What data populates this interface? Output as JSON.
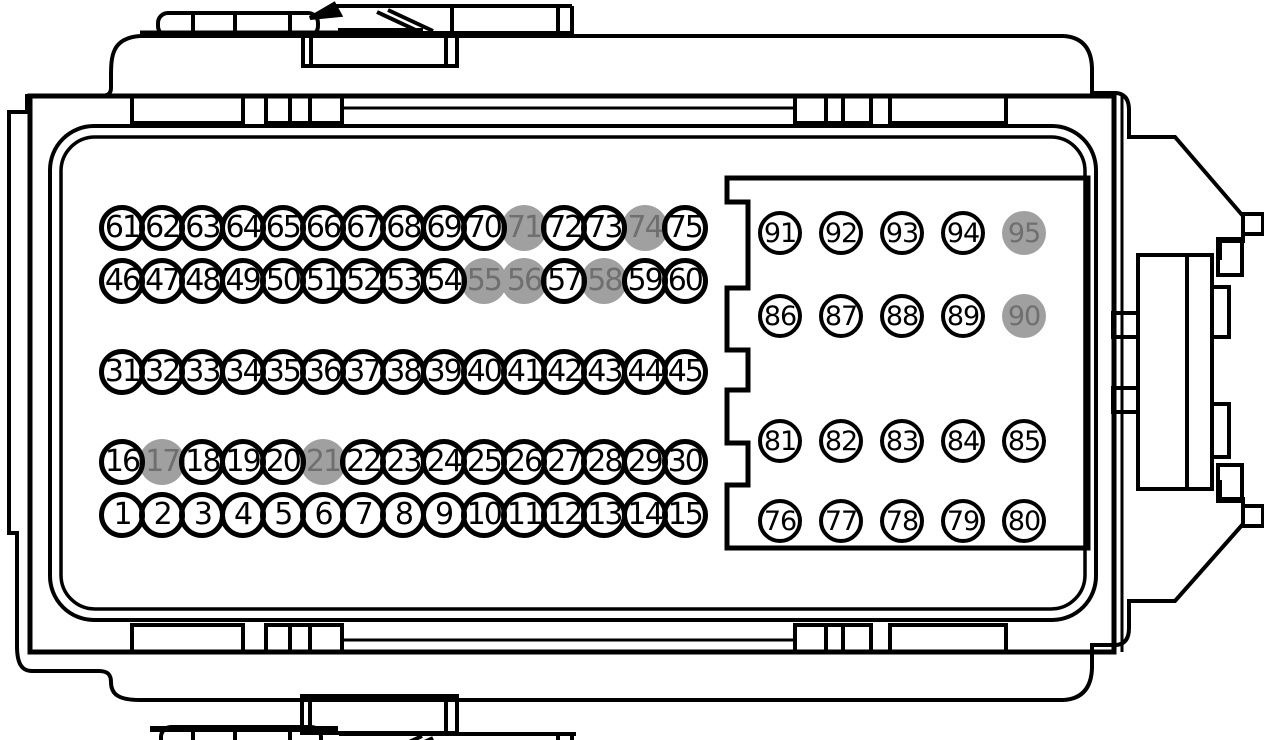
{
  "diagram": {
    "title": "95-pin connector face view pinout",
    "total_pins": 95,
    "highlighted_pins": [
      17,
      21,
      55,
      56,
      58,
      71,
      74,
      90,
      95
    ],
    "colors": {
      "line": "#000000",
      "pin_ring": "#000000",
      "pin_fill": "#ffffff",
      "pin_text": "#000000",
      "highlight_fill": "#a0a0a0",
      "highlight_text": "#6f6f6f",
      "background": "#ffffff"
    },
    "left_field": {
      "description": "pins 1-75, 5 rows of 15, numbered left to right, bottom row is 1-15",
      "diameter": 46,
      "ring_width": 5,
      "cx_start": 122,
      "cx_step": 40.2,
      "rows": [
        {
          "start": 61,
          "end": 75,
          "cy": 228
        },
        {
          "start": 46,
          "end": 60,
          "cy": 281
        },
        {
          "start": 31,
          "end": 45,
          "cy": 372
        },
        {
          "start": 16,
          "end": 30,
          "cy": 462
        },
        {
          "start": 1,
          "end": 15,
          "cy": 515
        }
      ]
    },
    "right_field": {
      "description": "pins 76-95, 4 rows of 5 inside keyed sub-connector box",
      "diameter": 44,
      "ring_width": 4.5,
      "cx": [
        780,
        841,
        902,
        963,
        1024
      ],
      "rows": [
        {
          "start": 91,
          "end": 95,
          "cy": 233
        },
        {
          "start": 86,
          "end": 90,
          "cy": 316
        },
        {
          "start": 81,
          "end": 85,
          "cy": 441
        },
        {
          "start": 76,
          "end": 80,
          "cy": 521
        }
      ]
    }
  }
}
